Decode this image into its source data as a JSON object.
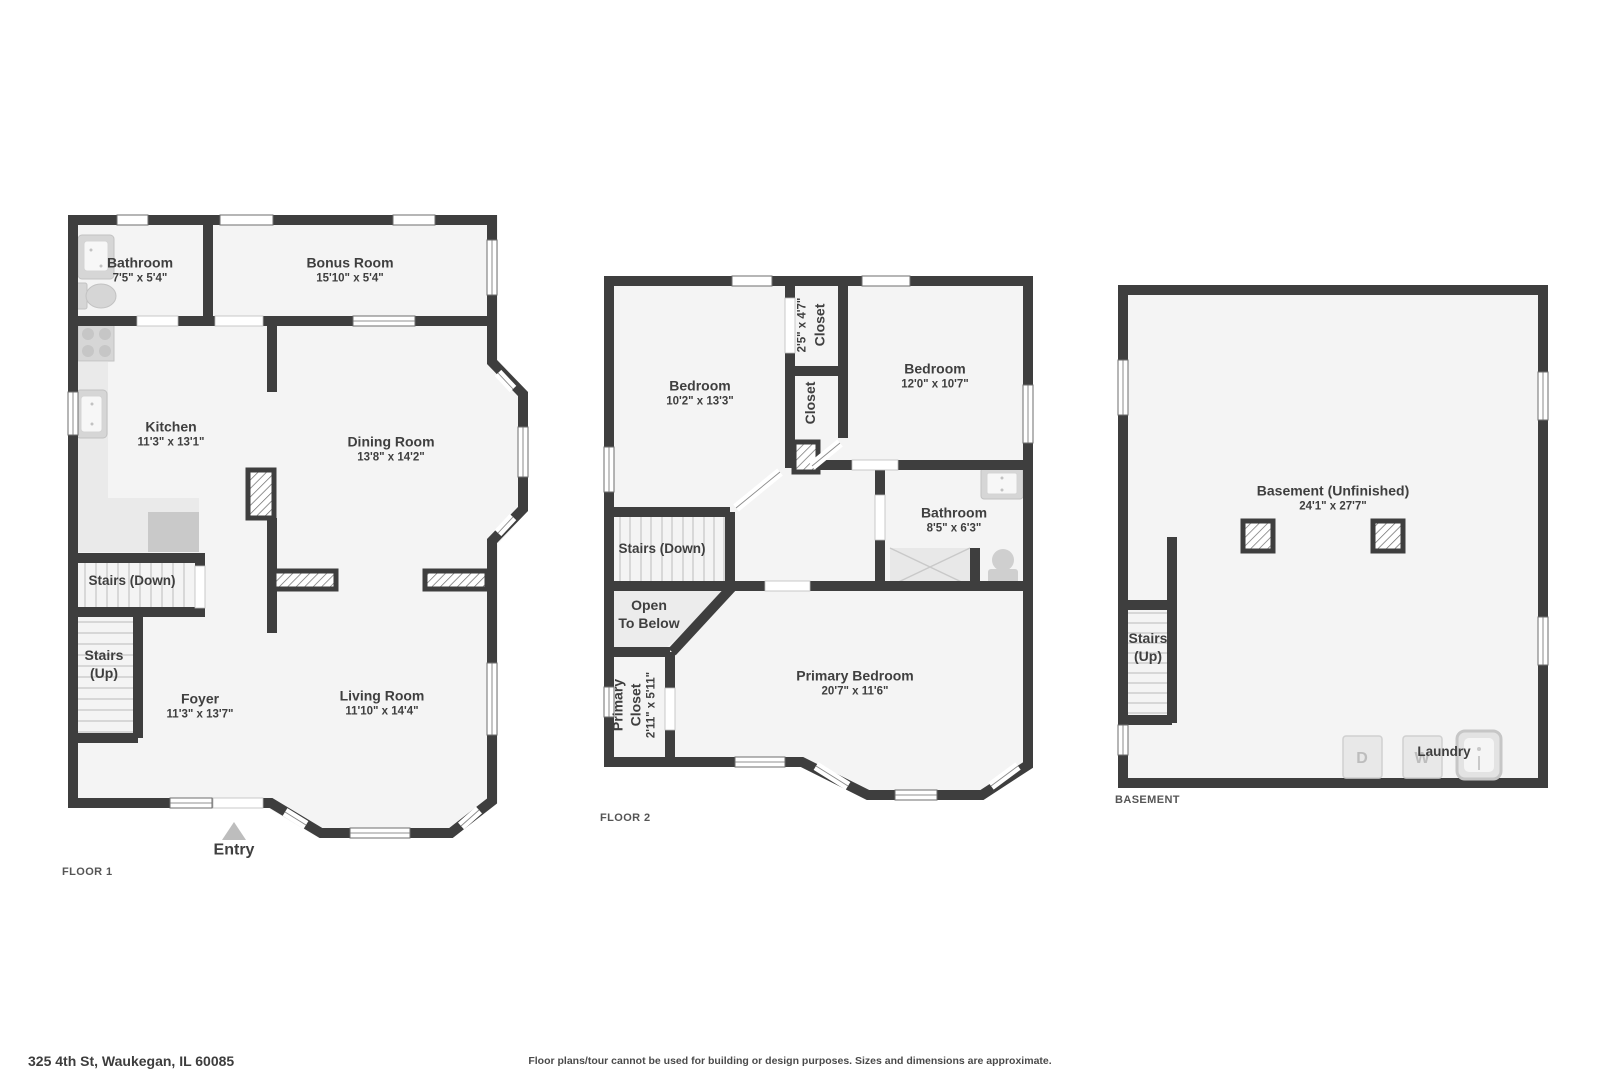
{
  "colors": {
    "wall": "#3e3e3e",
    "floor": "#f4f4f4",
    "fixture": "#d6d6d6",
    "text": "#3f3f3f"
  },
  "footer": {
    "address": "325 4th St, Waukegan, IL 60085",
    "disclaimer": "Floor plans/tour cannot be used for building or design purposes. Sizes and dimensions are approximate."
  },
  "floor1": {
    "label": "FLOOR 1",
    "entry": "Entry",
    "rooms": {
      "bathroom": {
        "name": "Bathroom",
        "dims": "7'5\" x 5'4\""
      },
      "bonus": {
        "name": "Bonus Room",
        "dims": "15'10\" x 5'4\""
      },
      "kitchen": {
        "name": "Kitchen",
        "dims": "11'3\" x 13'1\""
      },
      "dining": {
        "name": "Dining Room",
        "dims": "13'8\" x 14'2\""
      },
      "stairs_down": {
        "name": "Stairs (Down)"
      },
      "stairs_up": {
        "line1": "Stairs",
        "line2": "(Up)"
      },
      "foyer": {
        "name": "Foyer",
        "dims": "11'3\" x 13'7\""
      },
      "living": {
        "name": "Living Room",
        "dims": "11'10\" x 14'4\""
      }
    }
  },
  "floor2": {
    "label": "FLOOR 2",
    "rooms": {
      "bedroom_left": {
        "name": "Bedroom",
        "dims": "10'2\" x 13'3\""
      },
      "closet_top": {
        "name": "Closet",
        "dims": "2'5\" x 4'7\""
      },
      "closet_mid": {
        "name": "Closet"
      },
      "bedroom_right": {
        "name": "Bedroom",
        "dims": "12'0\" x 10'7\""
      },
      "bathroom": {
        "name": "Bathroom",
        "dims": "8'5\" x 6'3\""
      },
      "stairs_down": {
        "name": "Stairs (Down)"
      },
      "open_below": {
        "line1": "Open",
        "line2": "To Below"
      },
      "primary_closet": {
        "line1": "Primary",
        "line2": "Closet",
        "dims": "2'11\" x 5'11\""
      },
      "primary_bedroom": {
        "name": "Primary Bedroom",
        "dims": "20'7\" x 11'6\""
      }
    }
  },
  "basement": {
    "label": "BASEMENT",
    "rooms": {
      "main": {
        "name": "Basement (Unfinished)",
        "dims": "24'1\" x 27'7\""
      },
      "stairs_up": {
        "line1": "Stairs",
        "line2": "(Up)"
      },
      "laundry": {
        "name": "Laundry"
      }
    },
    "appliances": {
      "dryer": "D",
      "washer": "W"
    }
  }
}
